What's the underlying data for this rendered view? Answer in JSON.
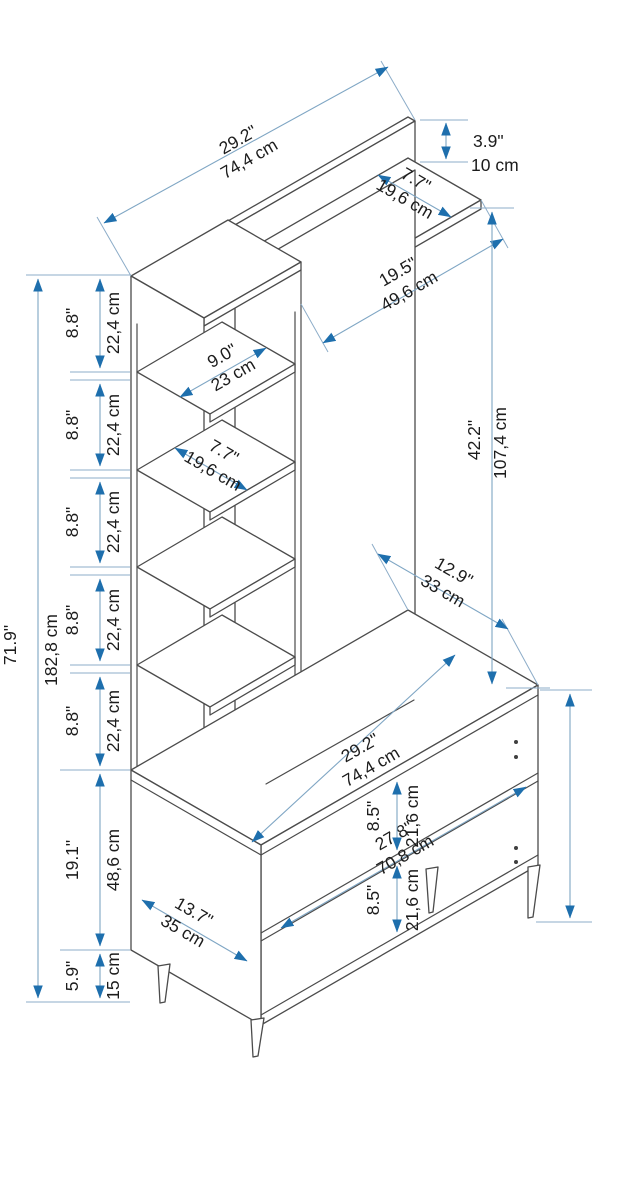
{
  "diagram": {
    "type": "furniture-dimension-drawing",
    "subject": "hall tree / coat stand with shelf tower, hanging panel, top shelf and shoe cabinet on tapered legs"
  },
  "colors": {
    "background": "#ffffff",
    "outline": "#4b4b4b",
    "dim_line": "#7fa6c4",
    "arrow": "#1e6fad",
    "text": "#1c1c1c"
  },
  "dims": {
    "total_width": {
      "in": "29.2\"",
      "cm": "74,4 cm"
    },
    "rail_height": {
      "in": "3.9\"",
      "cm": "10 cm"
    },
    "top_shelf_depth": {
      "in": "7.7\"",
      "cm": "19,6 cm"
    },
    "panel_width": {
      "in": "19.5\"",
      "cm": "49,6 cm"
    },
    "panel_height": {
      "in": "42.2\"",
      "cm": "107,4 cm"
    },
    "top_depth": {
      "in": "12.9\"",
      "cm": "33 cm"
    },
    "cabinet_width": {
      "in": "29.2\"",
      "cm": "74,4 cm"
    },
    "interior_width": {
      "in": "27.8\"",
      "cm": "70,8 cm"
    },
    "opening_height": {
      "in": "8.5\"",
      "cm": "21,6 cm"
    },
    "side_depth": {
      "in": "13.7\"",
      "cm": "35 cm"
    },
    "cabinet_height": {
      "in": "19.1\"",
      "cm": "48,6 cm"
    },
    "leg_height": {
      "in": "5.9\"",
      "cm": "15 cm"
    },
    "total_height": {
      "in": "71.9\"",
      "cm": "182,8 cm"
    },
    "shelf_width": {
      "in": "9.0\"",
      "cm": "23 cm"
    },
    "shelf_depth": {
      "in": "7.7\"",
      "cm": "19,6 cm"
    },
    "shelf_gap": {
      "in": "8.8\"",
      "cm": "22,4 cm"
    }
  }
}
